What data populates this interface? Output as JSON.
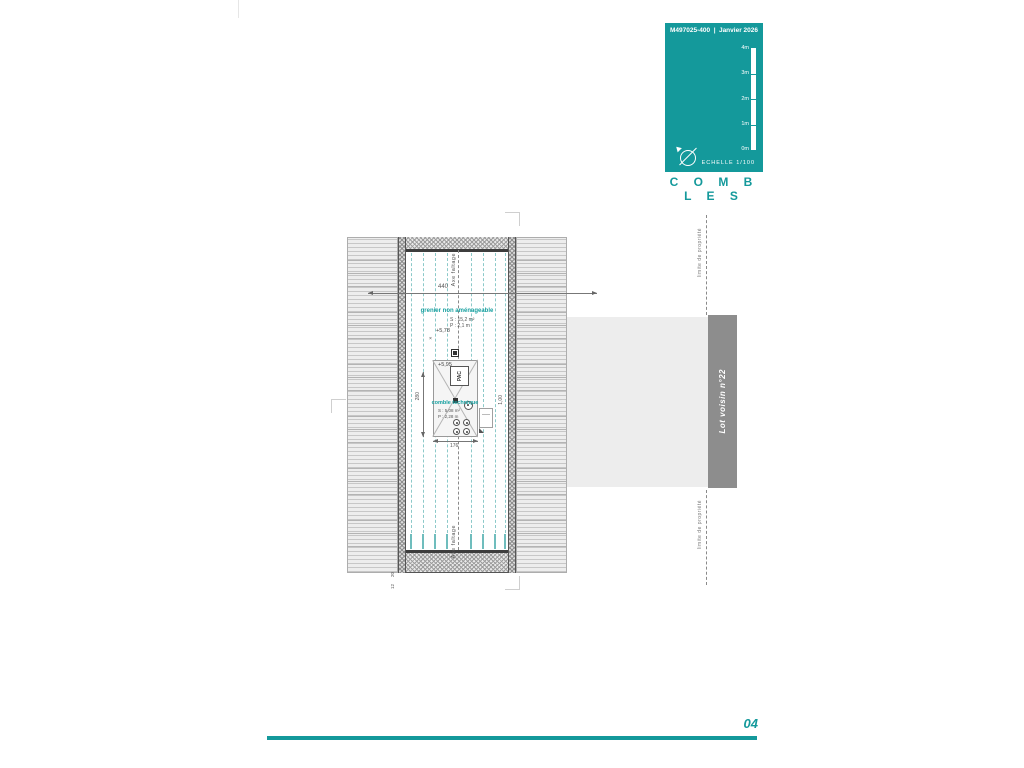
{
  "colors": {
    "accent": "#14999b",
    "neighbor_bar": "#8d8d8d"
  },
  "titleblock": {
    "ref": "M497025-400",
    "sep": "|",
    "date": "Janvier 2026",
    "scale_ticks": [
      "4m",
      "3m",
      "2m",
      "1m",
      "0m"
    ],
    "scale_label": "ECHELLE  1/100",
    "title": "C O M B L E S"
  },
  "plan": {
    "axis_label": "Axe faîtage",
    "dim_width": "440",
    "grenier": {
      "name": "grenier non aménageable",
      "surface": "S : 15,2 m²",
      "height": "P : 2,1 m",
      "level": "+5,78"
    },
    "tech": {
      "name": "comble technique",
      "surface": "S : 5,08 m²",
      "height": "P : 2,28 m",
      "level": "+5,95",
      "equipment": "PAC"
    },
    "dims": {
      "tech_h": "280",
      "tech_w": "176",
      "tech_r": "1,00",
      "wall_a": "20",
      "wall_b": "12"
    }
  },
  "site": {
    "boundary_label": "limite de propriété",
    "neighbor_label": "Lot voisin n°22"
  },
  "footer": {
    "page": "04"
  }
}
